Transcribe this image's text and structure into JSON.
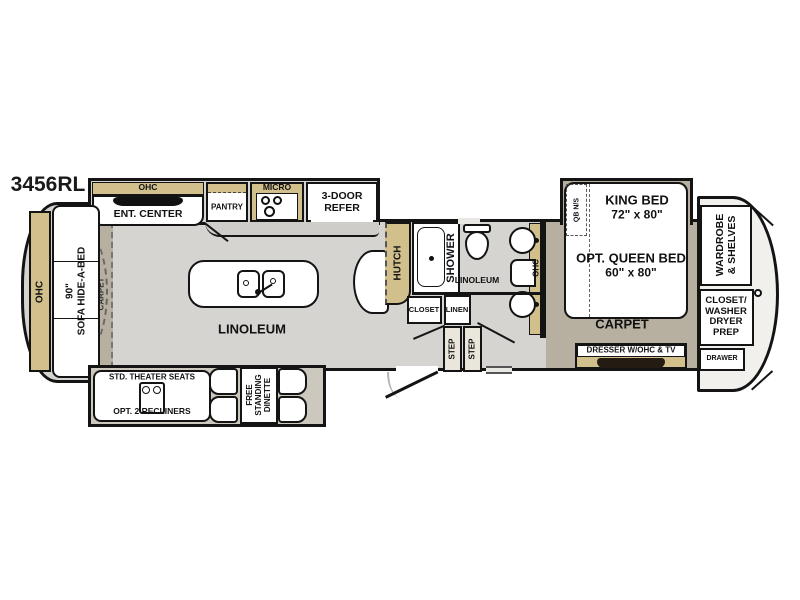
{
  "model": "3456RL",
  "front": {
    "ohc": "OHC",
    "sofa": [
      "90\"",
      "SOFA HIDE-A-BED"
    ],
    "carpet": "CARPET"
  },
  "kitchen_slide": {
    "ohc": "OHC",
    "ent_center": "ENT. CENTER",
    "pantry": "PANTRY",
    "micro": "MICRO",
    "refer": [
      "3-DOOR",
      "REFER"
    ]
  },
  "kitchen": {
    "floor": "LINOLEUM",
    "hutch": "HUTCH"
  },
  "bath": {
    "shower": "SHOWER",
    "floor": "LINOLEUM",
    "ohc": "OHC",
    "closet": "CLOSET",
    "linen": "LINEN"
  },
  "hall": {
    "steps": [
      "STEP",
      "STEP"
    ]
  },
  "bedroom": {
    "nightstand": "QB N/S",
    "king": [
      "KING BED",
      "72\" x 80\""
    ],
    "queen": [
      "OPT. QUEEN BED",
      "60\" x 80\""
    ],
    "floor": "CARPET",
    "dresser": "DRESSER W/OHC & TV"
  },
  "rear": {
    "wardrobe": [
      "WARDROBE",
      "& SHELVES"
    ],
    "closet_washer": [
      "CLOSET/",
      "WASHER",
      "DRYER",
      "PREP"
    ],
    "drawer": "DRAWER"
  },
  "living_slide": {
    "theater": "STD. THEATER SEATS",
    "recliners": "OPT. 2 RECLINERS",
    "dinette": [
      "FREE",
      "STANDING",
      "DINETTE"
    ]
  },
  "colors": {
    "cabinet_tan": "#d1c08c",
    "floor_gray": "#d5d4d1",
    "carpet": "#b7afa0",
    "wall": "#141414"
  }
}
